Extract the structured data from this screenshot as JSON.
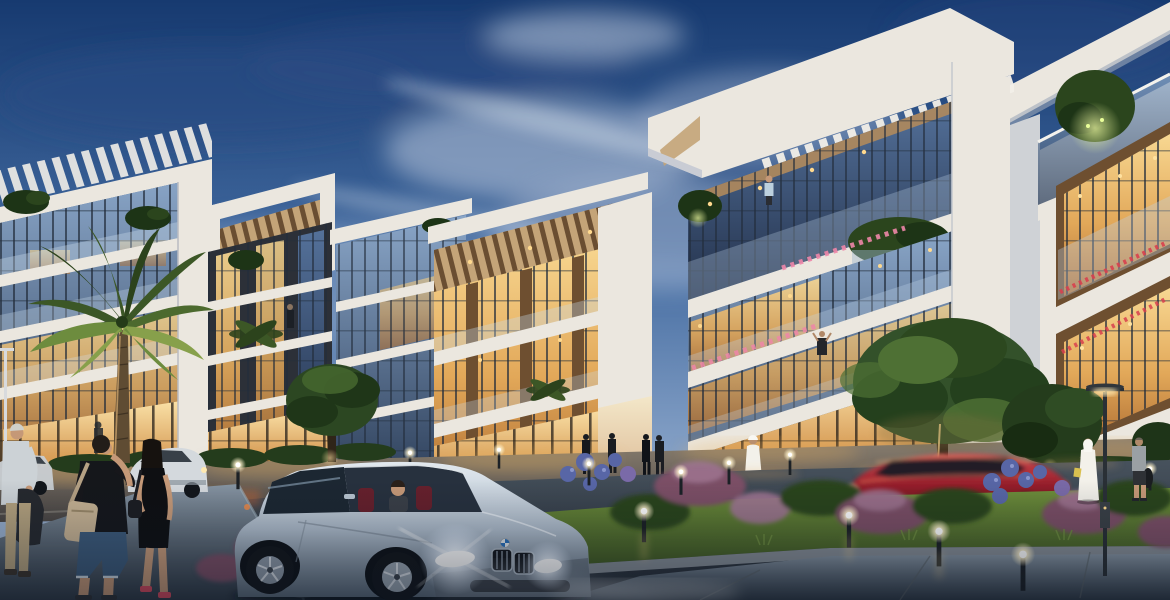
{
  "scene": {
    "title": "Residential complex at dusk - architectural rendering",
    "time_of_day": "dusk",
    "description": "Low-rise modern apartment buildings with illuminated glass facades, slatted pergola roofs and rooftop planting along a landscaped street with pedestrians, path lights and cars",
    "palette": {
      "sky-top": "#173a70",
      "sky-mid": "#41699f",
      "sky-low": "#7e9bc2",
      "sky-horizon": "#aabdd5",
      "cloud-light": "#cdd8e8",
      "cloud-dark": "#2b4c84",
      "wall-light": "#ebe7df",
      "wall-mid": "#cfd2d6",
      "wall-shade": "#9da9b9",
      "wood": "#b08a5c",
      "wood-light": "#c4a478",
      "wood-dark": "#6e4f30",
      "glass-cool": "#8aa6c8",
      "glass-deep": "#2f415c",
      "glass-night": "#1e2a3c",
      "warm-1": "#f8d892",
      "warm-2": "#e2a859",
      "warm-3": "#b06f33",
      "teal-accent": "#3fae9f",
      "grass-hi": "#6f8f3c",
      "grass-lo": "#31491c",
      "bush-green": "#2b451d",
      "bush-dark": "#1d3416",
      "bush-purple": "#7c4f66",
      "bush-mauve": "#a07592",
      "bush-blue": "#5866a6",
      "hedge": "#243c1c",
      "flower-pink": "#ee86a8",
      "flower-red": "#d8404e",
      "road-hi": "#47525d",
      "road-lo": "#242b34",
      "walk-hi": "#8795a3",
      "walk-lo": "#303b47",
      "curb": "#98a1a8",
      "car-hi": "#e2e9ef",
      "car-mid": "#aebccb",
      "car-lo": "#5d6c7b",
      "car-red": "#a01f2c",
      "tire": "#12161b",
      "glow-warm": "#ffde9e",
      "skin": "#c59877",
      "denim": "#3c5a7a",
      "kandura": "#f3f1ea",
      "cloth-black": "#15171b",
      "bag-tan": "#c6b293"
    },
    "buildings": [
      {
        "id": "building-a",
        "style": "glass curtain wall, rooftop slat pergola, roof shrubs, gold-lit lobby"
      },
      {
        "id": "building-b",
        "style": "slender tower, open pergola crown with wood soffit, vertical lit window strips"
      },
      {
        "id": "building-c",
        "style": "white pergola slab roof, cool reflective glazing"
      },
      {
        "id": "building-d",
        "style": "timber-clad bays, wood slat pergola, recessed downlights, lit balconies"
      },
      {
        "id": "building-e",
        "style": "large white slatted roof canopy, glass balconies, planters, pink flower boxes"
      },
      {
        "id": "building-f",
        "style": "wood-lined window bays, rooftop terrace tree with uplight, red balcony flowers"
      }
    ],
    "vehicles": [
      {
        "id": "silver-coupe",
        "desc": "silver coupe, headlights flaring, driver visible, red interior"
      },
      {
        "id": "red-coupe",
        "desc": "red sports car, motion blurred, driving past"
      },
      {
        "id": "white-sedan",
        "desc": "white car parked at curb"
      },
      {
        "id": "white-sedan-far",
        "desc": "second distant parked car at left edge"
      }
    ],
    "people": [
      {
        "id": "elderly-man",
        "desc": "grey-haired man, light shirt, khaki trousers, dark bag behind back"
      },
      {
        "id": "man-black-tshirt",
        "desc": "man in black t-shirt, denim shorts, tan crossbody bag"
      },
      {
        "id": "woman-black-dress",
        "desc": "dark-haired woman in black dress, red shoes"
      },
      {
        "id": "man-kandura-center",
        "desc": "man in white kandura on plaza walkway"
      },
      {
        "id": "man-kandura-right",
        "desc": "man in white kandura and ghutra near street lamp"
      },
      {
        "id": "man-grey-shirt",
        "desc": "man in grey shirt holding dark jacket"
      },
      {
        "id": "balcony-resident",
        "desc": "person standing at upper glass balcony"
      },
      {
        "id": "balcony-photographer",
        "desc": "figure with raised arms on mid balcony"
      },
      {
        "id": "storefront-silhouettes",
        "desc": "pedestrians along lit ground-floor glazing"
      }
    ],
    "landscape": [
      "tall palm tree",
      "secondary palm crowns",
      "street trees",
      "purple and mauve shrubs",
      "blue hydrangeas",
      "lawn median",
      "hedges"
    ],
    "lighting": [
      "warm interior glow",
      "bollard path lights",
      "tall street lamp",
      "car headlights",
      "tree uplights"
    ]
  }
}
